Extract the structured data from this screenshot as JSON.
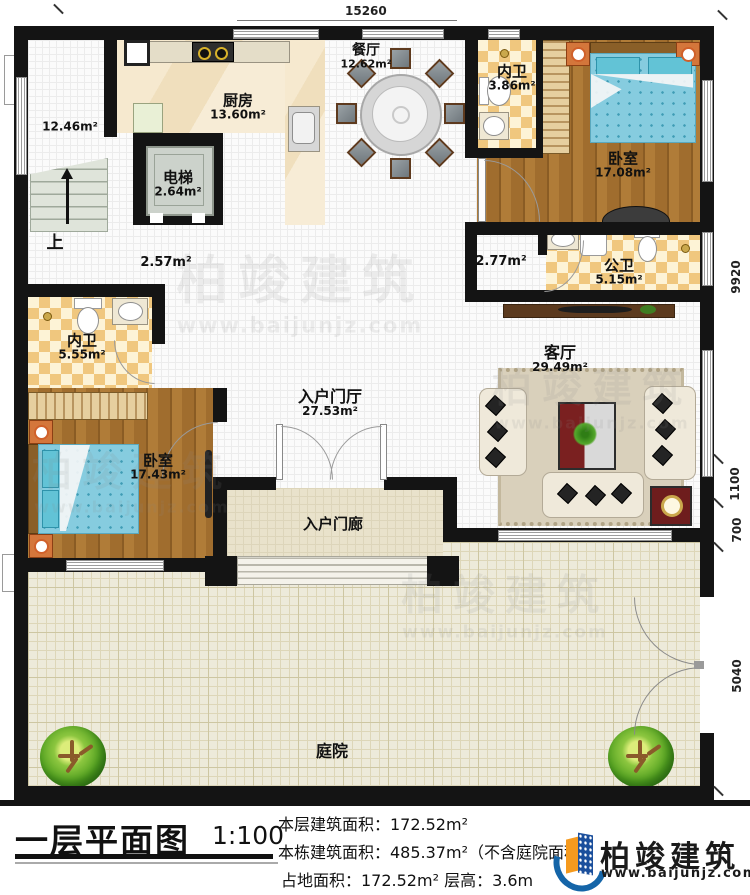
{
  "plan": {
    "dim_top": "15260",
    "dim_right_1": "9920",
    "dim_right_2": "1100",
    "dim_right_3": "700",
    "dim_right_4": "5040",
    "up": "上",
    "watermark_brand": "柏竣建筑",
    "watermark_url": "www.baijunjz.com"
  },
  "rooms": {
    "stairwell": {
      "area": "12.46m²"
    },
    "kitchen": {
      "name": "厨房",
      "area": "13.60m²"
    },
    "elevator": {
      "name": "电梯",
      "area": "2.64m²"
    },
    "dining": {
      "name": "餐厅",
      "area": "12.62m²"
    },
    "bath_top": {
      "name": "内卫",
      "area": "3.86m²"
    },
    "bedroom_right": {
      "name": "卧室",
      "area": "17.08m²"
    },
    "hall_left": {
      "area": "2.57m²"
    },
    "hall_right": {
      "area": "2.77m²"
    },
    "bath_public": {
      "name": "公卫",
      "area": "5.15m²"
    },
    "bath_left": {
      "name": "内卫",
      "area": "5.55m²"
    },
    "bedroom_left": {
      "name": "卧室",
      "area": "17.43m²"
    },
    "entry_hall": {
      "name": "入户门厅",
      "area": "27.53m²"
    },
    "living": {
      "name": "客厅",
      "area": "29.49m²"
    },
    "porch": {
      "name": "入户门廊"
    },
    "courtyard": {
      "name": "庭院"
    }
  },
  "title_block": {
    "title": "一层平面图",
    "scale": "1:100",
    "stat_floor": "本层建筑面积：172.52m²",
    "stat_building": "本栋建筑面积：485.37m²（不含庭院面积）",
    "stat_land": "占地面积：172.52m²  层高：3.6m",
    "logo_name": "柏竣建筑",
    "logo_url": "www.baijunjz.com"
  }
}
